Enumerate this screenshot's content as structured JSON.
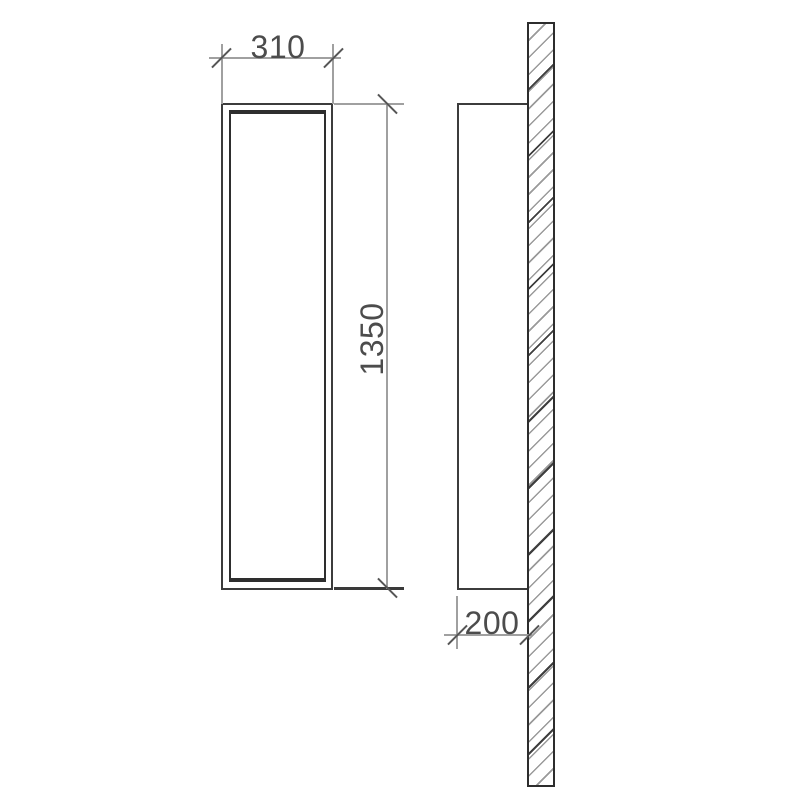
{
  "drawing": {
    "type": "technical-drawing",
    "subject": "tall wall-mounted cabinet, front view and side view against hatched wall section",
    "dimensions": {
      "width": {
        "label": "310",
        "orientation": "horizontal"
      },
      "height": {
        "label": "1350",
        "orientation": "vertical"
      },
      "depth": {
        "label": "200",
        "orientation": "horizontal"
      }
    },
    "colors": {
      "background": "#ffffff",
      "outline": "#3c3c3c",
      "dimension_lines": "#a0a0a0",
      "ticks": "#565656",
      "text": "#4c4c4c",
      "hatch_light": "#9a9a9a",
      "hatch_dark": "#3f3f3f"
    }
  }
}
